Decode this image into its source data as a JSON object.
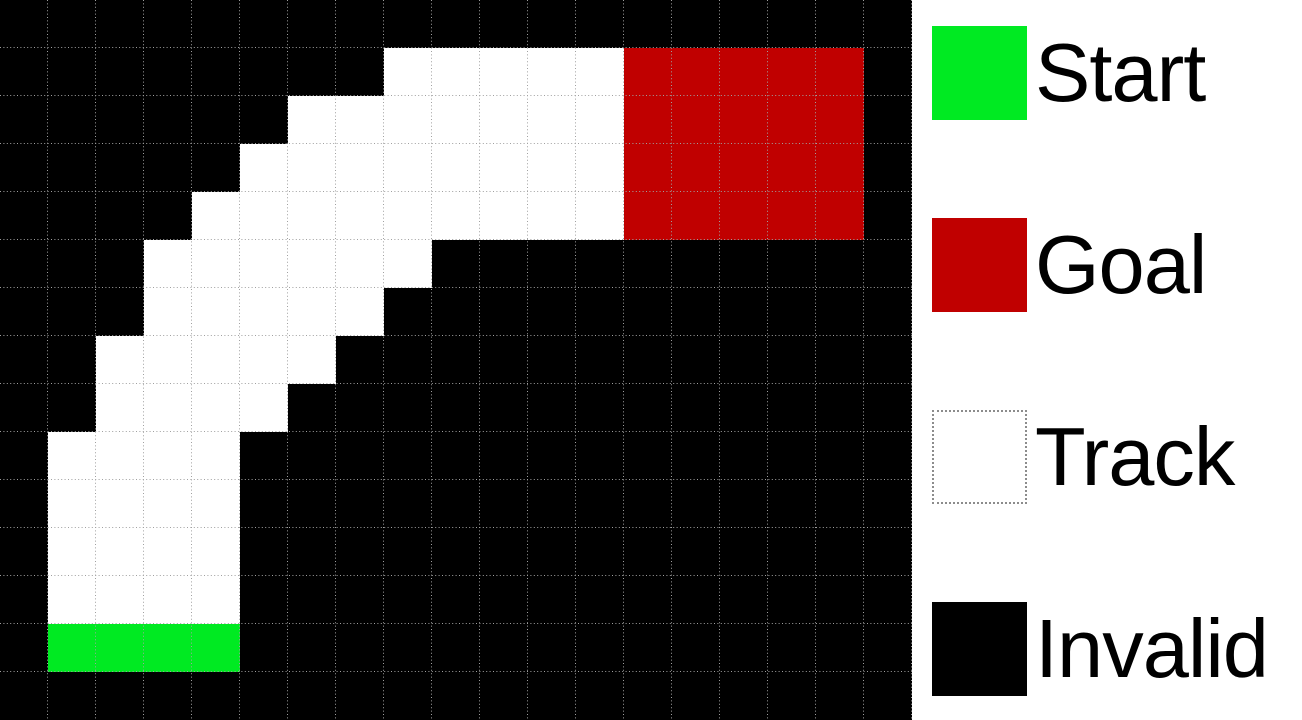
{
  "colors": {
    "invalid": "#000000",
    "track": "#ffffff",
    "start": "#00ea22",
    "goal": "#c00000",
    "gridline": "#a0a0a0",
    "legend_bg": "#ffffff",
    "legend_text": "#000000",
    "track_swatch_border": "#8c8c8c"
  },
  "grid": {
    "cols": 19,
    "rows": 15,
    "cell_size": 48,
    "char_meanings": {
      ".": "invalid",
      "T": "track",
      "S": "start",
      "G": "goal"
    },
    "map": [
      "...................",
      "........TTTTTGGGGG.",
      "......TTTTTTTGGGGG.",
      ".....TTTTTTTTGGGGG.",
      "....TTTTTTTTTGGGGG.",
      "...TTTTTT..........",
      "...TTTTT...........",
      "..TTTTT............",
      "..TTTT.............",
      ".TTTT..............",
      ".TTTT..............",
      ".TTTT..............",
      ".TTTT..............",
      ".SSSS..............",
      "..................."
    ]
  },
  "legend": {
    "items": [
      {
        "id": "start",
        "label": "Start",
        "swatch": "start"
      },
      {
        "id": "goal",
        "label": "Goal",
        "swatch": "goal"
      },
      {
        "id": "track",
        "label": "Track",
        "swatch": "track"
      },
      {
        "id": "invalid",
        "label": "Invalid",
        "swatch": "invalid"
      }
    ]
  }
}
